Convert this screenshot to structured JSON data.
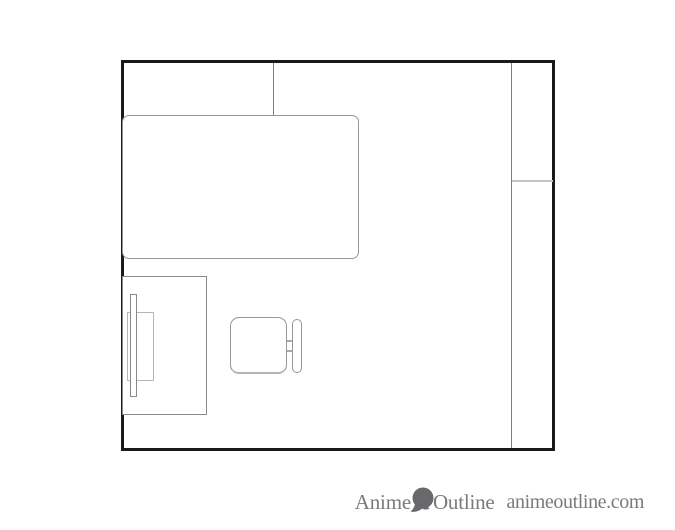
{
  "page": {
    "background_color": "#ffffff",
    "kind": "floor-plan line drawing, top-down view of a room"
  },
  "floor_plan": {
    "wall_color": "#1a1a1a",
    "furniture_line_color": "#979797",
    "partition_line_color": "#7f7f7f",
    "light_line_color": "#c4c4c4",
    "elements": [
      {
        "name": "room-outline",
        "shape": "rectangle with thick black walls"
      },
      {
        "name": "closet-partition",
        "shape": "vertical line from top wall to bed"
      },
      {
        "name": "right-partition",
        "shape": "vertical line forming strip along right wall"
      },
      {
        "name": "right-partition-divider",
        "shape": "short light horizontal line in right strip"
      },
      {
        "name": "bed",
        "shape": "large rounded rectangle, top-left"
      },
      {
        "name": "desk",
        "shape": "rectangle against left wall, bottom"
      },
      {
        "name": "monitor-base",
        "shape": "small rectangle on desk"
      },
      {
        "name": "monitor-screen",
        "shape": "thin tall bar on desk"
      },
      {
        "name": "chair-seat",
        "shape": "rounded square"
      },
      {
        "name": "chair-backrest",
        "shape": "thin rounded capsule right of seat"
      },
      {
        "name": "chair-connectors",
        "shape": "two short lines joining seat and backrest"
      }
    ]
  },
  "watermark": {
    "brand_prefix": "Anime",
    "brand_suffix": "Outline",
    "domain_text": "animeoutline.com",
    "text_color": "#7a7a7c",
    "logo_color": "#69696b",
    "logo_icon": "head-silhouette-icon"
  }
}
